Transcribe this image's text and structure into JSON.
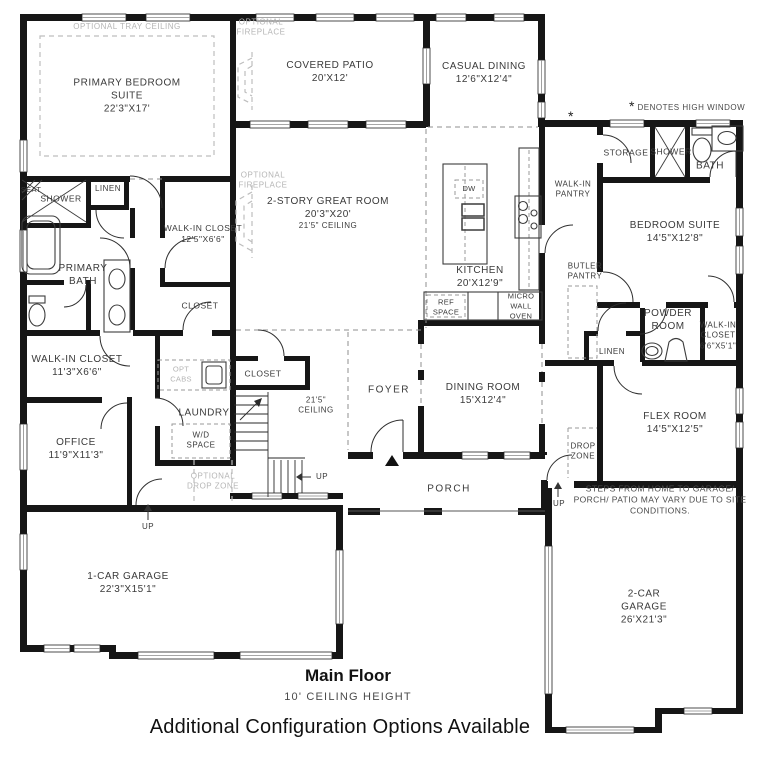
{
  "rooms": {
    "primary_bedroom_suite": {
      "name": "PRIMARY BEDROOM SUITE",
      "dims": "22'3\"X17'"
    },
    "covered_patio": {
      "name": "COVERED PATIO",
      "dims": "20'X12'"
    },
    "casual_dining": {
      "name": "CASUAL DINING",
      "dims": "12'6\"X12'4\""
    },
    "great_room": {
      "name": "2-STORY GREAT ROOM",
      "dims": "20'3\"X20'",
      "note": "21'5\" CEILING"
    },
    "kitchen": {
      "name": "KITCHEN",
      "dims": "20'X12'9\""
    },
    "walk_in_pantry": {
      "name": "WALK-IN PANTRY"
    },
    "butler_pantry": {
      "name": "BUTLER PANTRY"
    },
    "storage": {
      "name": "STORAGE"
    },
    "hall_shower": {
      "name": "SHOWER"
    },
    "hall_bath": {
      "name": "BATH"
    },
    "bedroom_suite": {
      "name": "BEDROOM SUITE",
      "dims": "14'5\"X12'8\""
    },
    "powder_room": {
      "name": "POWDER ROOM"
    },
    "walk_in_closet_bedroom": {
      "name": "WALK-IN CLOSET",
      "dims": "6'6\"X5'1\""
    },
    "hall_linen": {
      "name": "LINEN"
    },
    "flex_room": {
      "name": "FLEX ROOM",
      "dims": "14'5\"X12'5\""
    },
    "drop_zone": {
      "name": "DROP ZONE"
    },
    "dining_room": {
      "name": "DINING ROOM",
      "dims": "15'X12'4\""
    },
    "foyer": {
      "name": "FOYER"
    },
    "porch": {
      "name": "PORCH"
    },
    "stair_ceiling": {
      "name": "21'5\" CEILING"
    },
    "primary_bath": {
      "name": "PRIMARY BATH"
    },
    "seat": {
      "name": "SEAT"
    },
    "primary_shower": {
      "name": "SHOWER"
    },
    "primary_linen": {
      "name": "LINEN"
    },
    "walk_in_closet_primary": {
      "name": "WALK-IN CLOSET",
      "dims": "12'5\"X6'6\""
    },
    "walk_in_closet_hall": {
      "name": "WALK-IN CLOSET",
      "dims": "11'3\"X6'6\""
    },
    "hall_closet": {
      "name": "CLOSET"
    },
    "stair_closet": {
      "name": "CLOSET"
    },
    "laundry": {
      "name": "LAUNDRY",
      "wd": "W/D SPACE"
    },
    "office": {
      "name": "OFFICE",
      "dims": "11'9\"X11'3\""
    },
    "one_car_garage": {
      "name": "1-CAR GARAGE",
      "dims": "22'3\"X15'1\""
    },
    "two_car_garage": {
      "name": "2-CAR GARAGE",
      "dims": "26'X21'3\""
    }
  },
  "appliances": {
    "dw": "DW",
    "ref_space": "REF SPACE",
    "micro_wall_oven": "MICRO WALL OVEN",
    "opt_cabs": "OPT CABS"
  },
  "optional_features": {
    "tray_ceiling": "OPTIONAL TRAY CEILING",
    "fireplace": "OPTIONAL FIREPLACE",
    "drop_zone": "OPTIONAL DROP ZONE"
  },
  "annotations": {
    "up": "UP",
    "asterisk": "*",
    "high_window_note": "DENOTES HIGH WINDOW",
    "site_note": "STEPS FROM HOME TO GARAGE/ PORCH/ PATIO MAY VARY DUE TO SITE CONDITIONS."
  },
  "footer": {
    "floor_name": "Main Floor",
    "ceiling_height": "10' CEILING HEIGHT",
    "config_note": "Additional Configuration Options Available"
  },
  "colors": {
    "wall": "#161616",
    "optional_gray": "#b5b5b5",
    "label": "#3a3a3a"
  }
}
